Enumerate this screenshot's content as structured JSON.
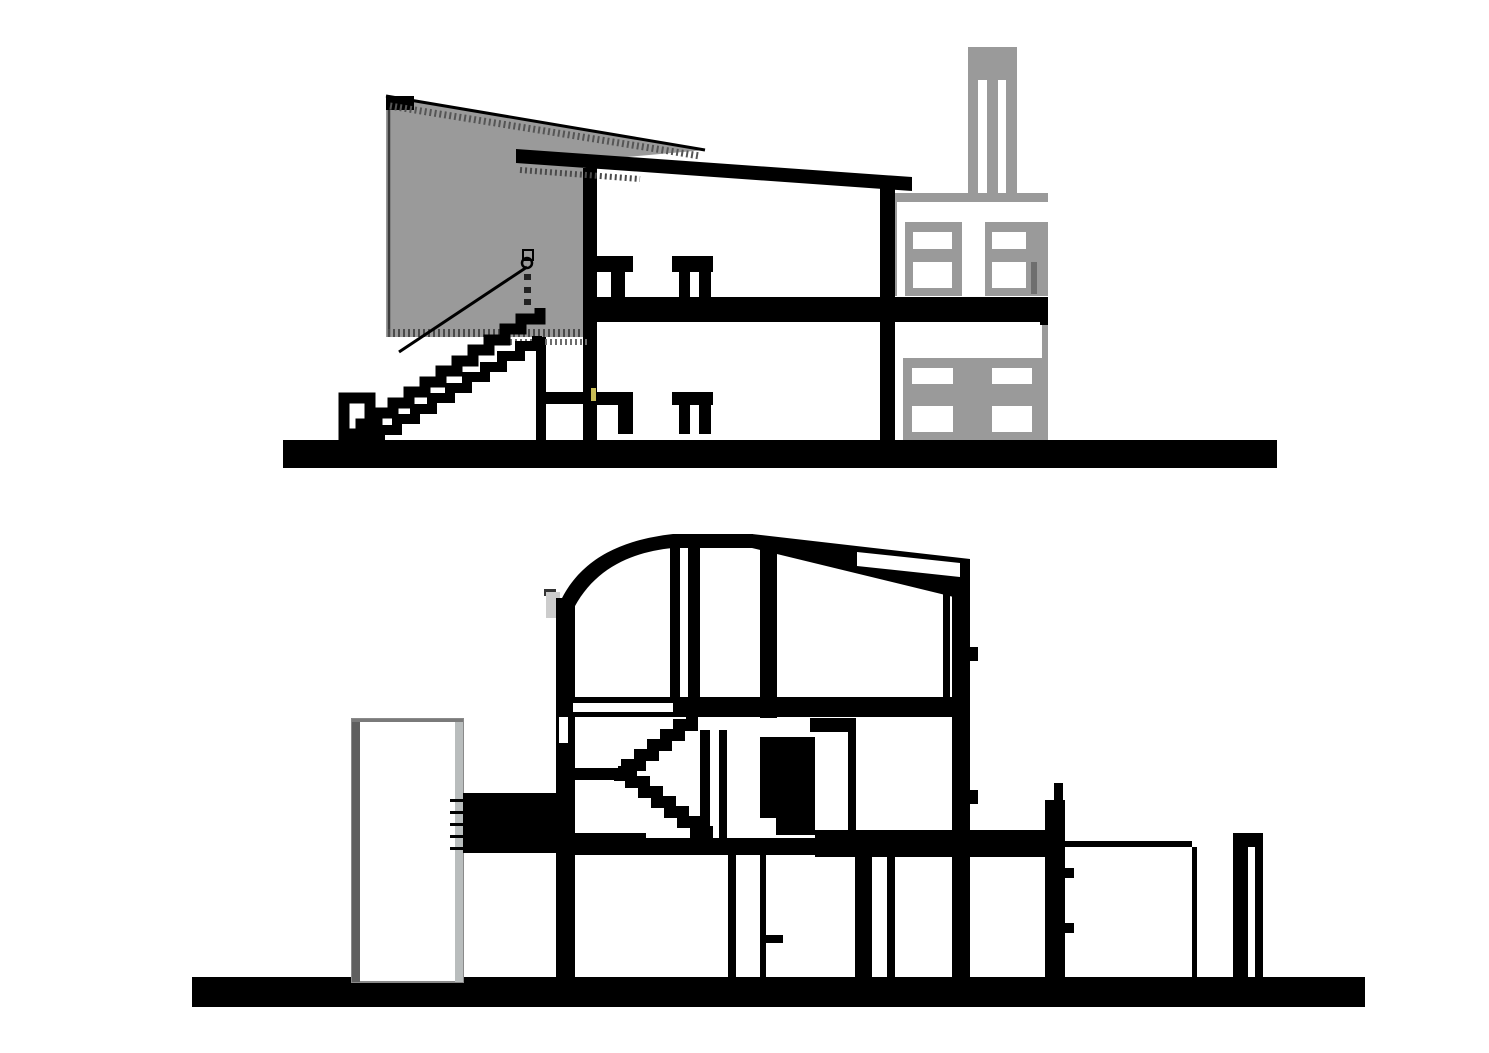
{
  "page": {
    "title": "architectural-section-drawings",
    "background": "#ffffff"
  },
  "colors": {
    "ink": "#000000",
    "white": "#ffffff",
    "gray": "#9a9a9a",
    "light_gray": "#cccccc",
    "dark_edge": "#3c3c3c",
    "hatch": "#4a4a4a",
    "panel_edge_dark": "#5f5f5f",
    "panel_edge_light": "#b9bdbd",
    "panel_edge_top": "#7a7a7a",
    "window_slot_dark": "#6e6e6e",
    "accent_yellow": "#c9bd55"
  },
  "figures": [
    {
      "id": "upper-section",
      "name": "cross-section-with-gray-ramp-wedge",
      "elements": [
        "gray-ramp-wedge",
        "entry-stair",
        "stair-handrail",
        "newel-frame",
        "two-storey-interior",
        "door-frames",
        "floor-slab",
        "sloped-roof",
        "rear-gray-factory",
        "factory-windows",
        "chimney",
        "ground-line",
        "yellow-door-handle"
      ]
    },
    {
      "id": "lower-section",
      "name": "longitudinal-section-with-curved-roof",
      "elements": [
        "curved-roof",
        "clerestory-slot",
        "freestanding-white-panel",
        "bridge-beam",
        "dog-leg-stair",
        "interior-walls",
        "service-shaft",
        "lower-rooms",
        "side-annex",
        "slender-posts",
        "ground-line"
      ]
    }
  ]
}
